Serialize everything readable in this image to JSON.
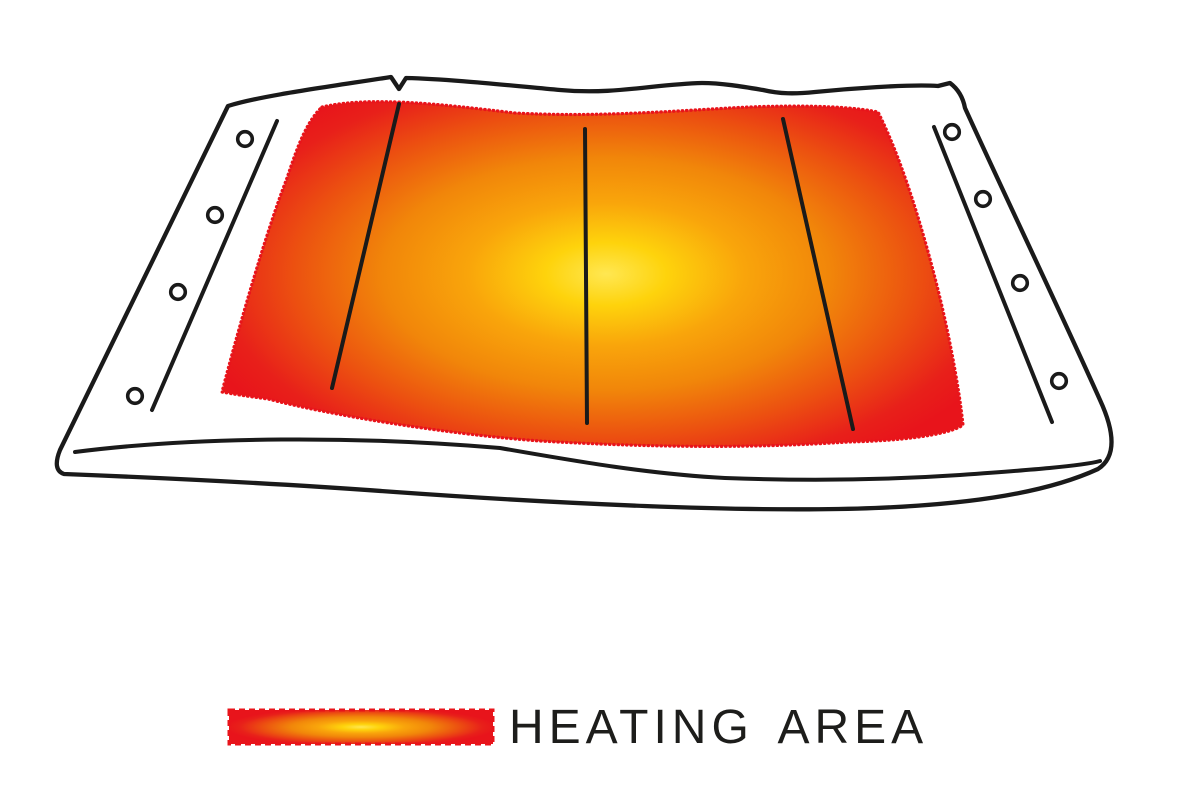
{
  "legend": {
    "label": "HEATING AREA"
  },
  "diagram": {
    "subject": "heating pad with highlighted heated zone",
    "heating_area_border_style": "dotted",
    "heating_wires_count": 3,
    "snap_holes_left_count": 4,
    "snap_holes_right_count": 4
  },
  "colors": {
    "background": "#ffffff",
    "outline": "#1a1a1a",
    "text": "#1d1d1b",
    "heat_red": "#e8141b",
    "heat_orange": "#f1860a",
    "heat_yellow": "#ffe752",
    "gradient_stops": [
      "#ffe752",
      "#fed30c",
      "#f9a50b",
      "#f1860a",
      "#ec5210",
      "#e8201a",
      "#e8141b"
    ]
  }
}
